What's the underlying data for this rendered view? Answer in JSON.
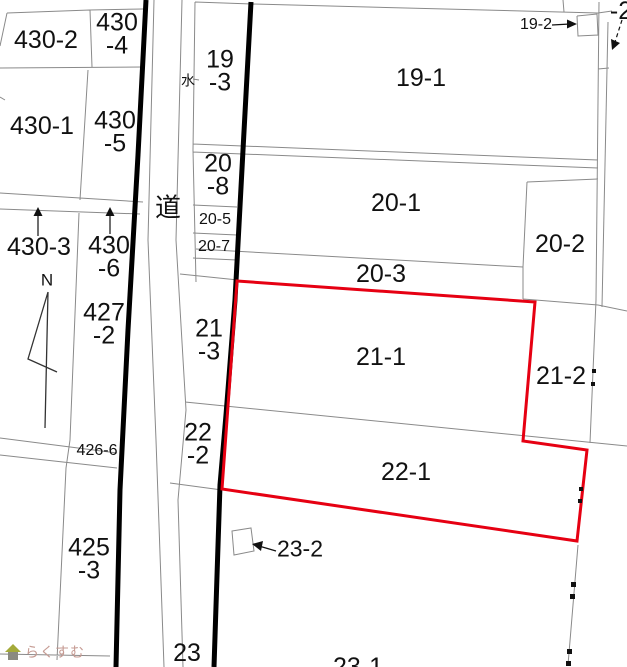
{
  "map": {
    "title": "cadastral-parcel-map",
    "colors": {
      "highlight_red": "#e60012",
      "boundary_gray": "#8a8a8a",
      "road_thick_black": "#000000",
      "watermark_text": "#c59a92",
      "watermark_roof": "#a4aa39"
    }
  },
  "labels": [
    {
      "name": "430-2",
      "text": "430-2"
    },
    {
      "name": "430-4",
      "text": "430\n-4"
    },
    {
      "name": "430-1",
      "text": "430-1"
    },
    {
      "name": "430-5",
      "text": "430\n-5"
    },
    {
      "name": "430-3",
      "text": "430-3"
    },
    {
      "name": "430-6",
      "text": "430\n-6"
    },
    {
      "name": "427-2",
      "text": "427\n-2"
    },
    {
      "name": "426-6",
      "text": "426-6"
    },
    {
      "name": "425-3",
      "text": "425\n-3"
    },
    {
      "name": "19-3",
      "text": "19\n-3"
    },
    {
      "name": "19-1",
      "text": "19-1"
    },
    {
      "name": "19-2",
      "text": "19-2"
    },
    {
      "name": "20-8",
      "text": "20\n-8"
    },
    {
      "name": "20-5",
      "text": "20-5"
    },
    {
      "name": "20-7",
      "text": "20-7"
    },
    {
      "name": "20-1",
      "text": "20-1"
    },
    {
      "name": "20-2",
      "text": "20-2"
    },
    {
      "name": "20-3",
      "text": "20-3"
    },
    {
      "name": "21-3",
      "text": "21\n-3"
    },
    {
      "name": "21-1",
      "text": "21-1"
    },
    {
      "name": "21-2",
      "text": "21-2"
    },
    {
      "name": "22-2",
      "text": "22\n-2"
    },
    {
      "name": "22-1",
      "text": "22-1"
    },
    {
      "name": "23-2",
      "text": "23-2"
    },
    {
      "name": "23",
      "text": "23"
    },
    {
      "name": "23-1",
      "text": "23-1"
    },
    {
      "name": "water",
      "text": "水"
    },
    {
      "name": "road",
      "text": "道"
    },
    {
      "name": "north",
      "text": "N"
    },
    {
      "name": "edge-partial",
      "text": "-2"
    }
  ],
  "watermark": {
    "text": "らくすむ"
  }
}
